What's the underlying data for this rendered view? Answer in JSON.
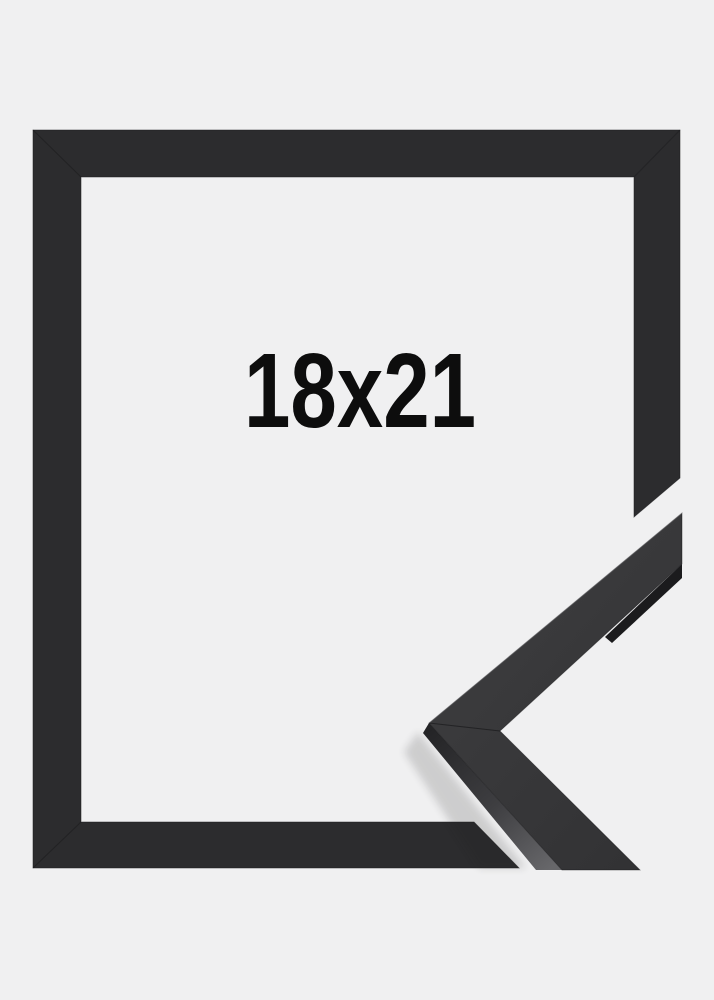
{
  "product": {
    "size_label": "18x21",
    "description": "black picture frame corner sample photo"
  },
  "colors": {
    "background": "#f0f0f1",
    "frame_front": "#2c2c2e",
    "frame_edge": "#1d1d1f",
    "sample_top_face_light": "#3b3b3d",
    "sample_top_face_dark": "#313133",
    "sample_side_dark": "#1b1b1d",
    "sample_strip_top": "#232325",
    "sample_strip_bottom": "#67676a",
    "label_text": "#0d0d0d"
  }
}
